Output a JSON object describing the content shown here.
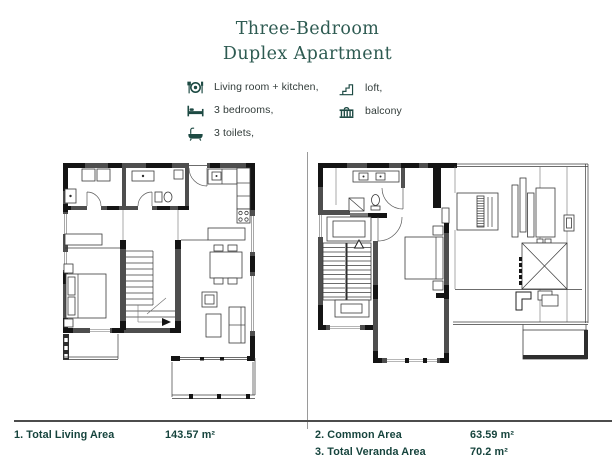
{
  "title": {
    "line1": "Three-Bedroom",
    "line2": "Duplex Apartment"
  },
  "legend": {
    "column1": [
      {
        "icon": "dining-icon",
        "label": "Living room + kitchen,"
      },
      {
        "icon": "bed-icon",
        "label": "3 bedrooms,"
      },
      {
        "icon": "bathtub-icon",
        "label": "3 toilets,"
      }
    ],
    "column2": [
      {
        "icon": "stairs-icon",
        "label": "loft,"
      },
      {
        "icon": "balcony-icon",
        "label": "balcony"
      }
    ]
  },
  "areas": [
    {
      "label": "1. Total Living Area",
      "value": "143.57 m²"
    },
    {
      "label": "2. Common Area",
      "value": "63.59 m²"
    },
    {
      "label": "3. Total Veranda Area",
      "value": "70.2 m²"
    }
  ],
  "floor_plans": [
    {
      "name": "first-level-plan"
    },
    {
      "name": "second-level-plan"
    }
  ],
  "colors": {
    "accent_teal": "#1d4a43",
    "title_teal": "#2e5b52",
    "area_text": "#16443d",
    "wall_dark": "#141414",
    "wall_gray": "#4e4e4e",
    "line_gray": "#3b3b3b"
  }
}
